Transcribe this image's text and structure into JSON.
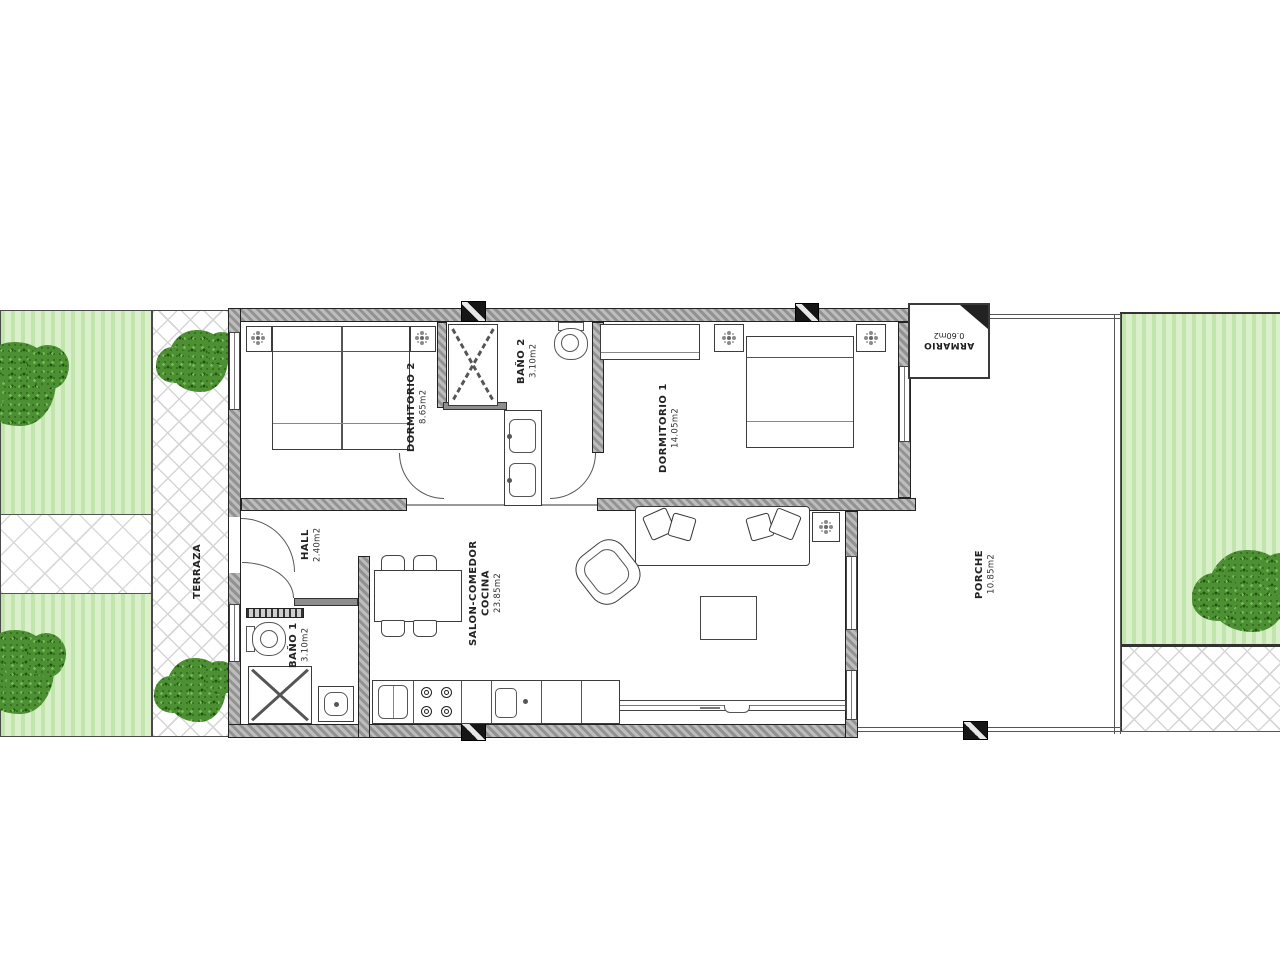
{
  "plan": {
    "terraza": {
      "name": "TERRAZA"
    },
    "rooms": {
      "dormitorio2": {
        "name": "DORMITORIO 2",
        "area": "8.65m2"
      },
      "bano2": {
        "name": "BAÑO 2",
        "area": "3.10m2"
      },
      "dormitorio1": {
        "name": "DORMITORIO 1",
        "area": "14.05m2"
      },
      "hall": {
        "name": "HALL",
        "area": "2.40m2"
      },
      "bano1": {
        "name": "BAÑO 1",
        "area": "3.10m2"
      },
      "salon": {
        "line1": "SALON-COMEDOR",
        "line2": "COCINA",
        "area": "23.85m2"
      },
      "porche": {
        "name": "PORCHE",
        "area": "10.85m2"
      },
      "armario": {
        "name": "ARMARIO",
        "area": "0.60m2"
      }
    },
    "colors": {
      "garden_light": "#daf0ca",
      "garden_dark": "#c2e4ad",
      "tree_green": "#4d9033",
      "wall_gray": "#a3a3a3",
      "hatch_gray": "#d6d6d6",
      "line_dark": "#444444"
    }
  }
}
